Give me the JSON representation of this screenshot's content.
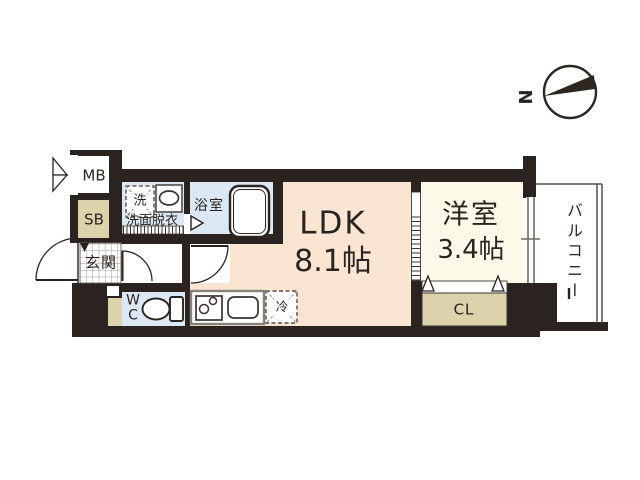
{
  "plan": {
    "type": "floorplan",
    "compass": {
      "north": "N"
    },
    "rooms": {
      "ldk": {
        "name": "LDK",
        "size": "8.1帖"
      },
      "bedroom": {
        "name": "洋室",
        "size": "3.4帖"
      },
      "balcony": {
        "name": "バルコニー"
      },
      "bath": {
        "name": "浴室"
      },
      "washroom": {
        "name": "洗面脱衣"
      },
      "entrance": {
        "name": "玄関"
      },
      "wc": {
        "name": "W\nC"
      }
    },
    "fixtures": {
      "meter_box": "MB",
      "shoe_box": "SB",
      "closet": "CL",
      "washer": "洗",
      "refrigerator": "冷"
    },
    "colors": {
      "wall": "#2b2320",
      "ldk_fill": "#fae5d3",
      "bedroom_fill": "#fcf9e9",
      "wet_area_fill": "#dbe8f4",
      "storage_fill": "#dcd3ad"
    }
  }
}
